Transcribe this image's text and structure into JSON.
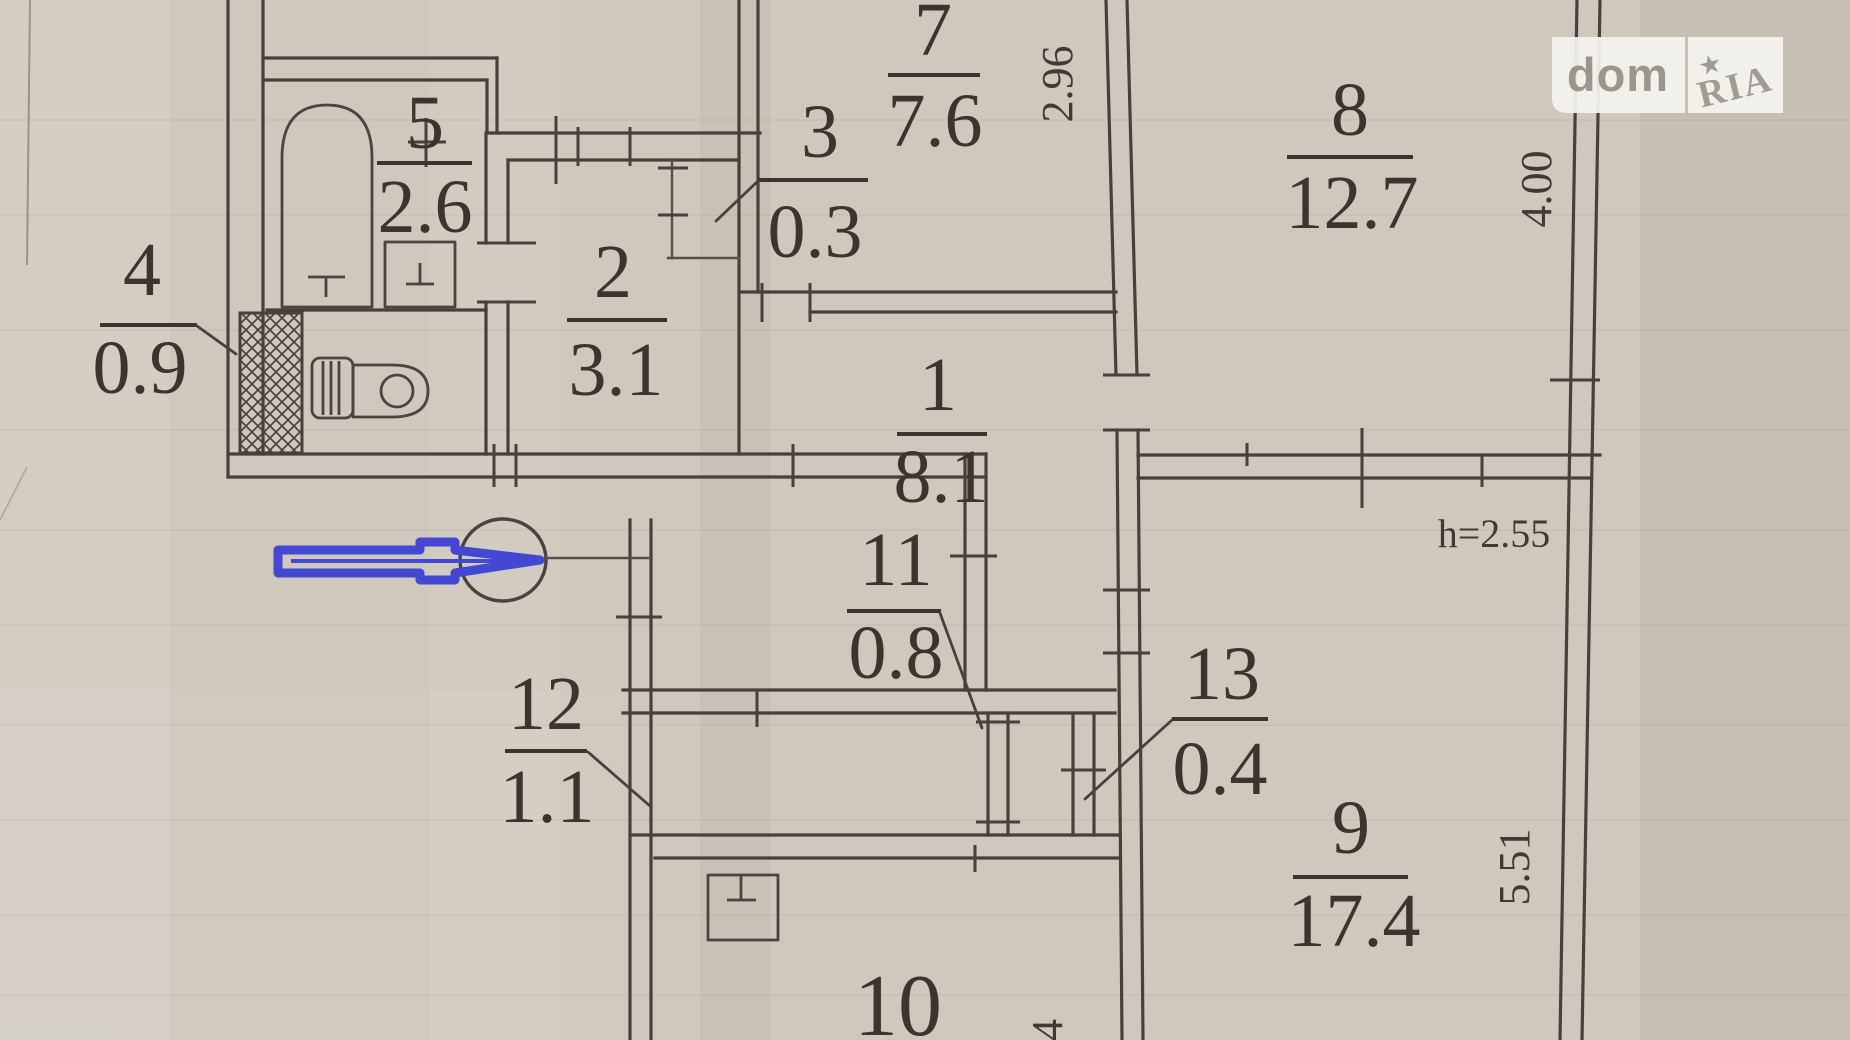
{
  "watermark": {
    "dom": "dom",
    "ria": "RIA",
    "star_icon": "★"
  },
  "rooms": {
    "r1": {
      "number": "1",
      "area": "8.1"
    },
    "r2": {
      "number": "2",
      "area": "3.1"
    },
    "r3": {
      "number": "3",
      "area": "0.3"
    },
    "r4": {
      "number": "4",
      "area": "0.9"
    },
    "r5": {
      "number": "5",
      "area": "2.6"
    },
    "r7": {
      "number": "7",
      "area": "7.6"
    },
    "r8": {
      "number": "8",
      "area": "12.7"
    },
    "r9": {
      "number": "9",
      "area": "17.4"
    },
    "r10": {
      "number": "10"
    },
    "r11": {
      "number": "11",
      "area": "0.8"
    },
    "r12": {
      "number": "12",
      "area": "1.1"
    },
    "r13": {
      "number": "13",
      "area": "0.4"
    }
  },
  "dimensions": {
    "room7_width": "2.96",
    "room8_width": "4.00",
    "room9_height": "5.51",
    "ceiling_height": "h=2.55",
    "bottom_partial": "4"
  },
  "colors": {
    "paper": "#cfc8bc",
    "ink": "#46413a",
    "annotation_blue": "#4347d2",
    "watermark_gray": "#a19c92"
  }
}
